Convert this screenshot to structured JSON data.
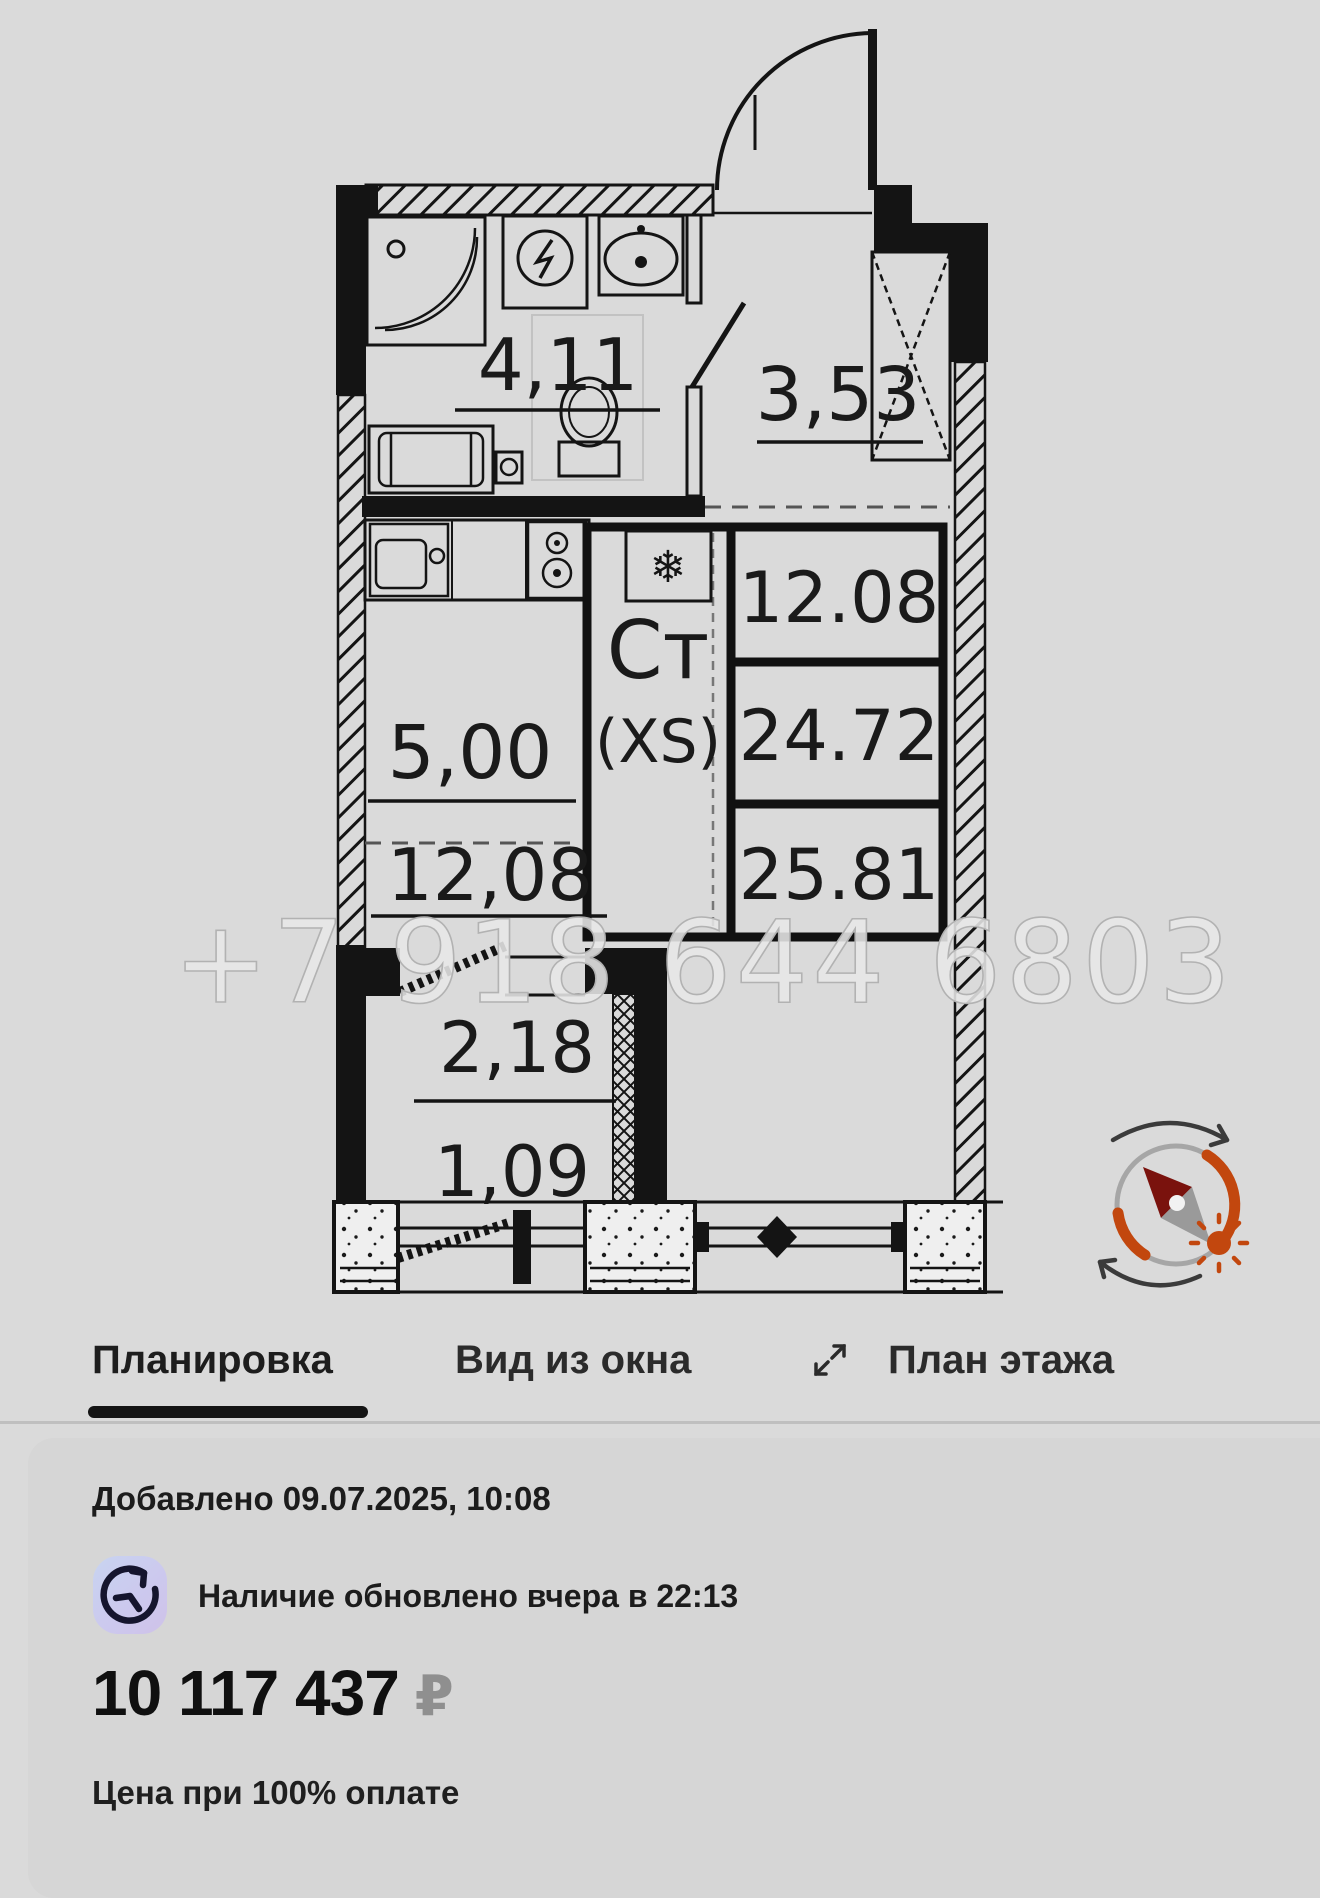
{
  "floorplan": {
    "rooms": {
      "bathroom_area": "4,11",
      "hall_area": "3,53",
      "kitchen_area": "5,00",
      "living_area": "12,08",
      "balcony_area": "2,18",
      "balcony_reduced_area": "1,09"
    },
    "info_box": {
      "type_line1": "Ст",
      "type_line2": "(XS)",
      "snowflake": "❄",
      "living_space": "12.08",
      "area_without_balcony": "24.72",
      "total_area": "25.81"
    },
    "watermark": "+7 918 644 6803"
  },
  "tabs": [
    {
      "label": "Планировка",
      "active": true
    },
    {
      "label": "Вид из окна",
      "active": false
    },
    {
      "label": "План этажа",
      "active": false
    }
  ],
  "details": {
    "added": "Добавлено 09.07.2025, 10:08",
    "availability": "Наличие обновлено вчера в 22:13",
    "price": "10 117 437",
    "currency": "₽",
    "price_note": "Цена при 100% оплате"
  },
  "colors": {
    "page_bg": "#dadada",
    "card_bg": "#d6d6d6",
    "ink": "#141414",
    "compass_orange": "#c2470e",
    "compass_needle_red": "#7a120d",
    "badge_gradient_start": "#c8d4f1",
    "badge_gradient_end": "#cfc2e9",
    "watermark_gray": "#e7e7e7"
  }
}
